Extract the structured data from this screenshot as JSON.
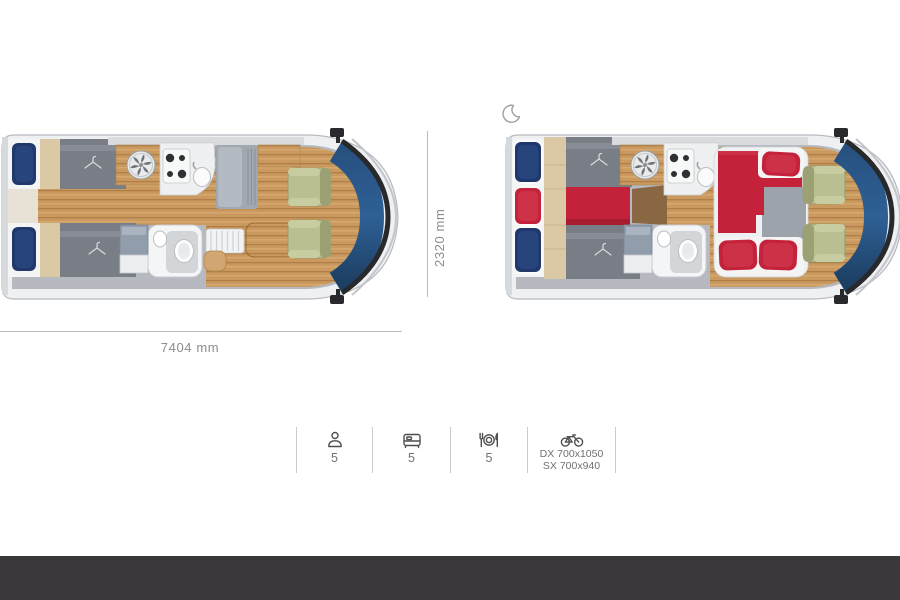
{
  "floorplans": {
    "day": {
      "name": "motorhome-floorplan-day"
    },
    "night": {
      "name": "motorhome-floorplan-night",
      "icon": "moon-icon"
    }
  },
  "dimensions": {
    "length": "7404 mm",
    "width": "2320 mm"
  },
  "specs": [
    {
      "icon": "person-icon",
      "value": "5"
    },
    {
      "icon": "bed-icon",
      "value": "5"
    },
    {
      "icon": "dining-icon",
      "value": "5"
    },
    {
      "icon": "bike-garage-icon",
      "line1": "DX 700x1050",
      "line2": "SX 700x940"
    }
  ],
  "colors": {
    "navy": "#20386b",
    "red": "#c4223a",
    "duvet": "#787d86",
    "beige": "#dbc9a5",
    "wood": "#c9995f",
    "wood-dark": "#b07f48",
    "green": "#b9bf90",
    "windshield": "#2e6096",
    "body": "#eef0f2",
    "floor": "#b6bac0",
    "footer": "#3a383b",
    "dim-line": "#b9bcc0",
    "text-dim": "#8c8c8c",
    "text-spec": "#707070",
    "divider": "#cbcbcb",
    "icon-stroke": "#4f4f4f"
  }
}
